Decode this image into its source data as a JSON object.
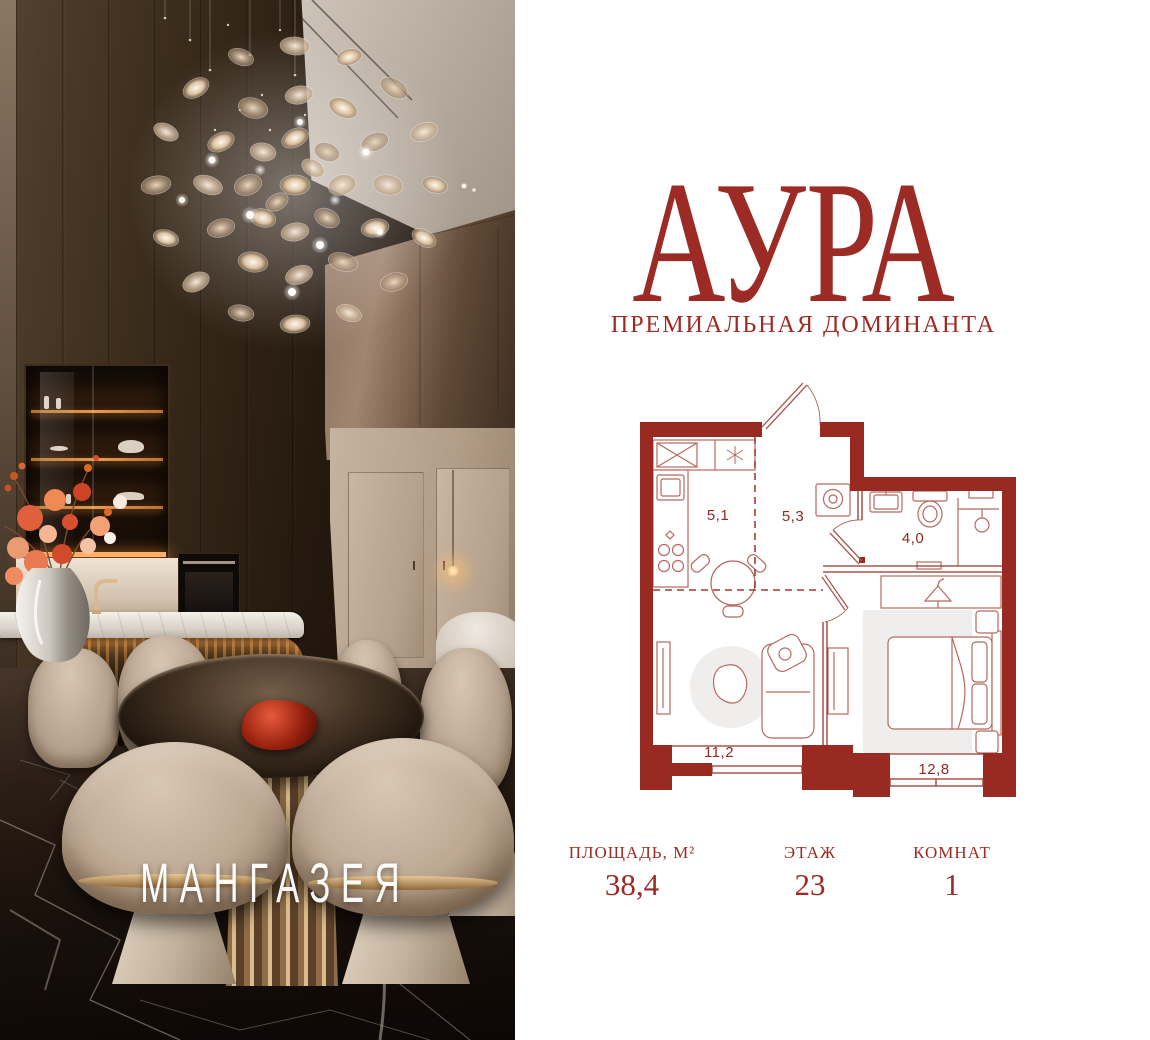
{
  "brand": {
    "project": "АУРА",
    "tagline": "ПРЕМИАЛЬНАЯ ДОМИНАНТА",
    "developer": "МАНГАЗЕЯ"
  },
  "floorplan": {
    "areas": {
      "kitchen": "5,1",
      "hallway": "5,3",
      "bathroom": "4,0",
      "living": "11,2",
      "bedroom": "12,8"
    }
  },
  "specs": [
    {
      "label": "ПЛОЩАДЬ, М²",
      "value": "38,4"
    },
    {
      "label": "ЭТАЖ",
      "value": "23"
    },
    {
      "label": "КОМНАТ",
      "value": "1"
    }
  ],
  "colors": {
    "accent": "#9c2b25",
    "plan_wall": "#992a21",
    "plan_line": "#b5695f",
    "plan_rug": "#efeeec"
  }
}
